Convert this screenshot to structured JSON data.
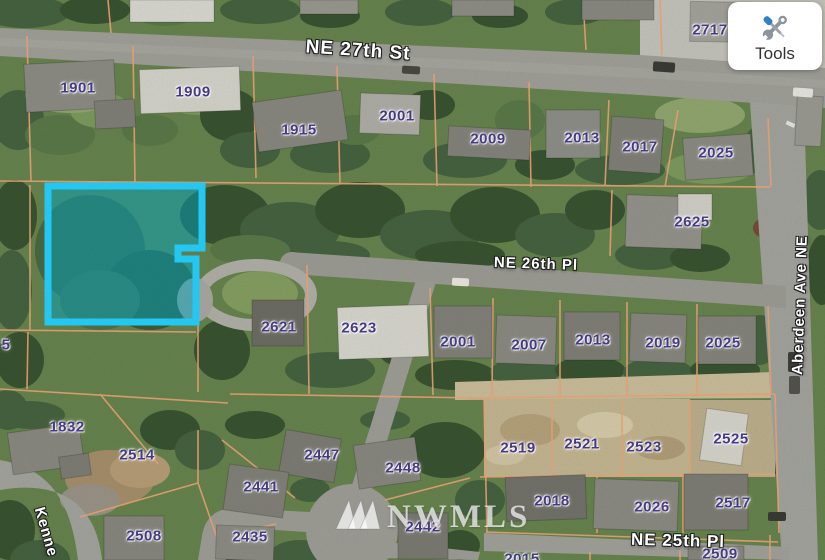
{
  "window": {
    "width": 825,
    "height": 560,
    "description": "aerial parcel map view"
  },
  "tools_button": {
    "label": "Tools",
    "icon": "screwdriver-wrench-icon"
  },
  "watermark": {
    "text": "NWMLS",
    "logo": "triple-triangle-logo"
  },
  "highlighted_parcel": {
    "border_color": "#27d3ff",
    "fill_color": "rgba(0,176,205,0.48)",
    "outline_points": "48,186 202,186 202,248 178,248 178,259 196,259 196,322 48,322"
  },
  "colors": {
    "parcel_line": "#f1a878",
    "parcel_label": "#473a85",
    "street_label": "#ffffff",
    "tree_green": "#3a5431",
    "road_gray": "#a2a29b",
    "dirt_tan": "#c6b893"
  },
  "map": {
    "street_labels": [
      {
        "text": "NE 27th St",
        "x": 358,
        "y": 51,
        "rot": 4,
        "size": 19
      },
      {
        "text": "NE 26th Pl",
        "x": 536,
        "y": 264,
        "rot": 2,
        "size": 15
      },
      {
        "text": "Aberdeen Ave NE",
        "x": 800,
        "y": 305,
        "rot": -88,
        "size": 15
      },
      {
        "text": "NE 25th Pl",
        "x": 678,
        "y": 541,
        "rot": 1.5,
        "size": 17
      },
      {
        "text": "Kenne",
        "x": 46,
        "y": 532,
        "rot": 74,
        "size": 15
      }
    ],
    "parcel_labels": [
      {
        "text": "2717",
        "x": 710,
        "y": 30
      },
      {
        "text": "1901",
        "x": 78,
        "y": 88
      },
      {
        "text": "1909",
        "x": 193,
        "y": 92
      },
      {
        "text": "1915",
        "x": 299,
        "y": 130
      },
      {
        "text": "2001",
        "x": 397,
        "y": 116
      },
      {
        "text": "2009",
        "x": 488,
        "y": 139
      },
      {
        "text": "2013",
        "x": 582,
        "y": 138
      },
      {
        "text": "2017",
        "x": 640,
        "y": 147
      },
      {
        "text": "2025",
        "x": 716,
        "y": 153
      },
      {
        "text": "2625",
        "x": 692,
        "y": 222
      },
      {
        "text": "2621",
        "x": 279,
        "y": 327
      },
      {
        "text": "2623",
        "x": 359,
        "y": 328
      },
      {
        "text": "2001",
        "x": 458,
        "y": 342
      },
      {
        "text": "2007",
        "x": 529,
        "y": 345
      },
      {
        "text": "2013",
        "x": 593,
        "y": 340
      },
      {
        "text": "2019",
        "x": 663,
        "y": 343
      },
      {
        "text": "2025",
        "x": 723,
        "y": 343
      },
      {
        "text": "5",
        "x": 6,
        "y": 345
      },
      {
        "text": "1832",
        "x": 67,
        "y": 427
      },
      {
        "text": "2514",
        "x": 137,
        "y": 455
      },
      {
        "text": "2508",
        "x": 144,
        "y": 536
      },
      {
        "text": "2447",
        "x": 322,
        "y": 455
      },
      {
        "text": "2448",
        "x": 403,
        "y": 468
      },
      {
        "text": "2441",
        "x": 261,
        "y": 487
      },
      {
        "text": "2435",
        "x": 250,
        "y": 537
      },
      {
        "text": "2442",
        "x": 423,
        "y": 527
      },
      {
        "text": "2519",
        "x": 518,
        "y": 448
      },
      {
        "text": "2521",
        "x": 582,
        "y": 444
      },
      {
        "text": "2523",
        "x": 644,
        "y": 447
      },
      {
        "text": "2525",
        "x": 731,
        "y": 439
      },
      {
        "text": "2018",
        "x": 552,
        "y": 501
      },
      {
        "text": "2026",
        "x": 652,
        "y": 507
      },
      {
        "text": "2517",
        "x": 733,
        "y": 503
      },
      {
        "text": "2509",
        "x": 720,
        "y": 554
      },
      {
        "text": "2015",
        "x": 522,
        "y": 559
      }
    ]
  }
}
